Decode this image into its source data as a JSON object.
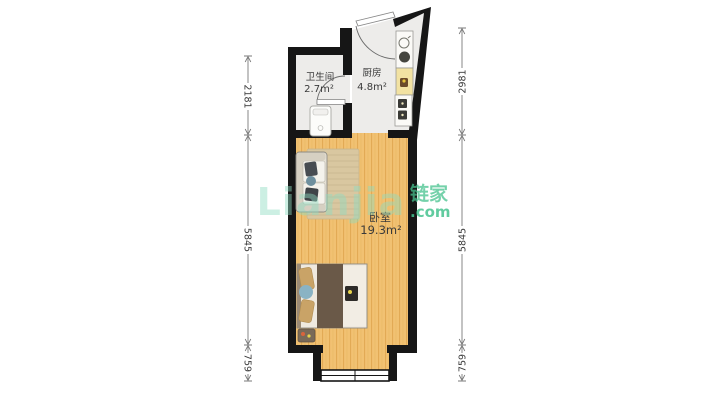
{
  "watermark": {
    "wordmark": "Lianjia",
    "cn": "链家",
    "domain": ".com",
    "accent_color": "#45c28e",
    "wordmark_color": "#8fdcc0"
  },
  "rooms": [
    {
      "id": "bathroom",
      "name": "卫生间",
      "area": "2.7m²"
    },
    {
      "id": "kitchen",
      "name": "厨房",
      "area": "4.8m²"
    },
    {
      "id": "bedroom",
      "name": "卧室",
      "area": "19.3m²"
    }
  ],
  "dimensions": {
    "unit": "mm",
    "left": [
      {
        "value": "2181"
      },
      {
        "value": "5845"
      },
      {
        "value": "759"
      }
    ],
    "right": [
      {
        "value": "2981"
      },
      {
        "value": "5845"
      },
      {
        "value": "759"
      }
    ]
  },
  "colors": {
    "wall": "#161616",
    "wood_floor": "#f1c172",
    "tile_floor": "#edecea",
    "counter_yellow": "#f2e2a2",
    "rug": "#d9c7a0",
    "duvet_brown": "#6a5948"
  }
}
